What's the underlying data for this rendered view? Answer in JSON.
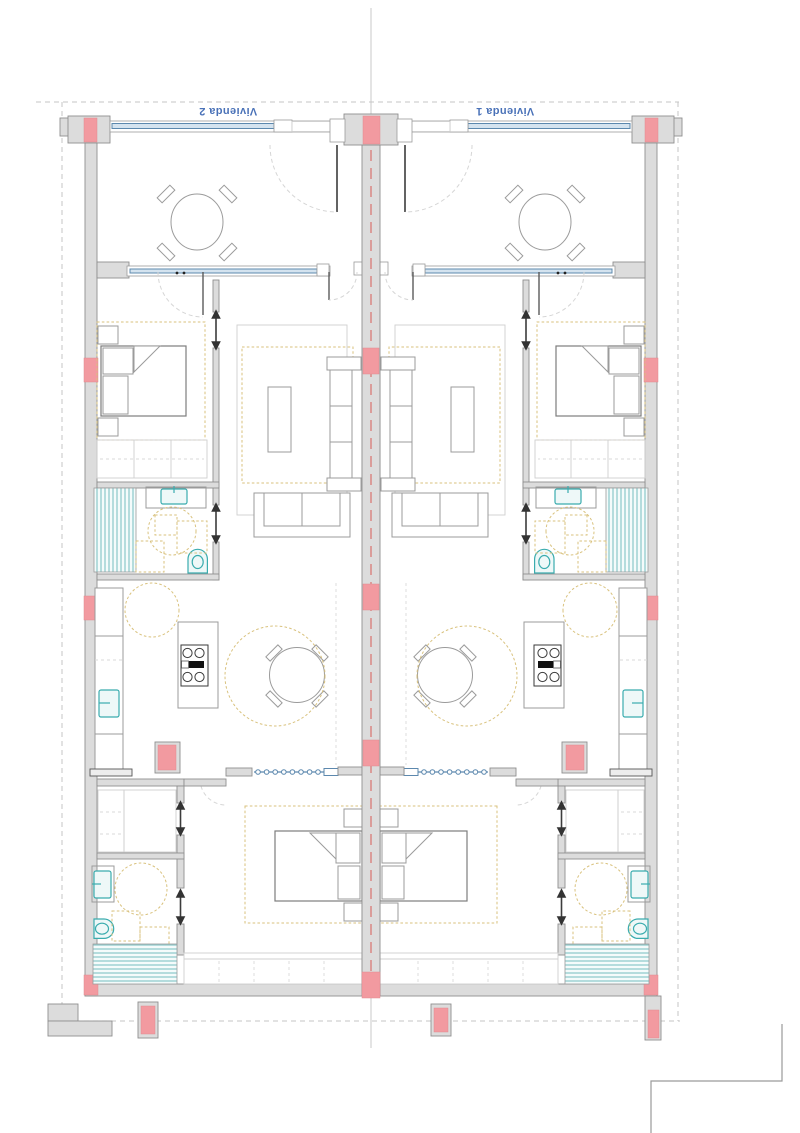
{
  "labels": {
    "unit_left": "Vivienda 2",
    "unit_right": "Vivienda 1"
  },
  "colors": {
    "paper": "#ffffff",
    "wall-fill": "#dcdcdc",
    "wall-stroke": "#8f8f8f",
    "column-pink": "#f29aa0",
    "window-blue": "#5c88ae",
    "window-blue-fill": "#d4e3ef",
    "label-blue": "#4a72b8",
    "fixture-teal": "#3aacae",
    "shower-teal": "#7fc3c5",
    "accent-yellow": "#d9c27e",
    "furniture-gray": "#9b9b9b",
    "axis-red": "#d97a76",
    "boundary-gray": "#c4c4c4"
  }
}
